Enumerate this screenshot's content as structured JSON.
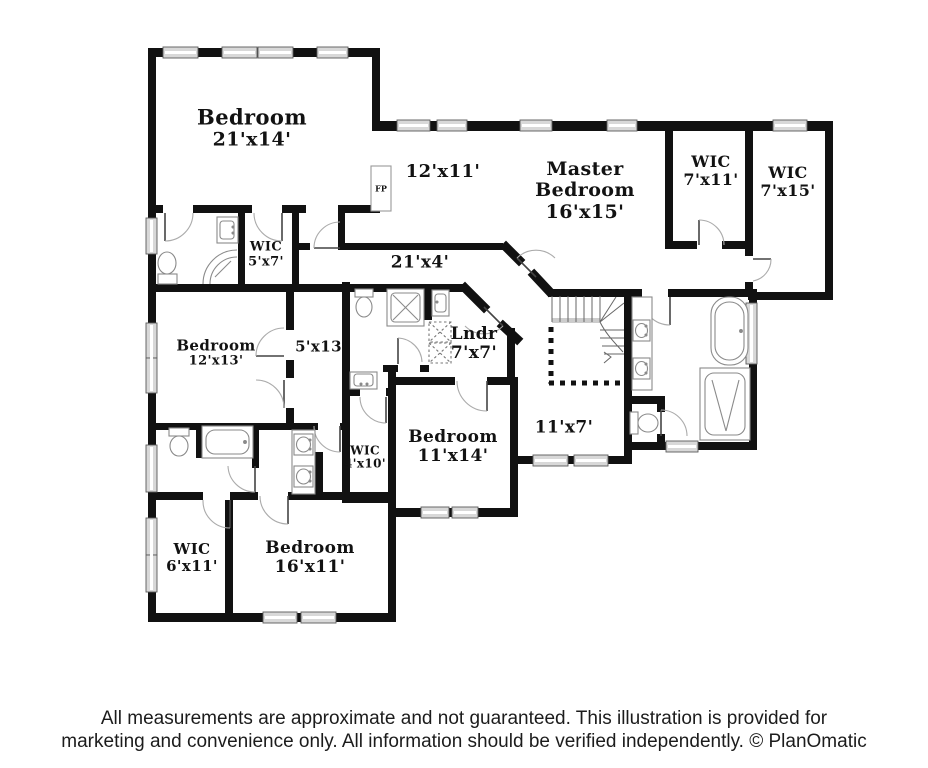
{
  "rooms": {
    "bedroom_21x14": {
      "name": "Bedroom",
      "dims": "21'x14'"
    },
    "sitting_12x11": {
      "dims": "12'x11'"
    },
    "master_bedroom": {
      "name": "Master",
      "name2": "Bedroom",
      "dims": "16'x15'"
    },
    "wic_7x11": {
      "name": "WIC",
      "dims": "7'x11'"
    },
    "wic_7x15": {
      "name": "WIC",
      "dims": "7'x15'"
    },
    "wic_5x7": {
      "name": "WIC",
      "dims": "5'x7'"
    },
    "hall_21x4": {
      "dims": "21'x4'"
    },
    "bedroom_12x13": {
      "name": "Bedroom",
      "dims": "12'x13'"
    },
    "hall_5x13": {
      "dims": "5'x13'"
    },
    "laundry_7x7": {
      "name": "Lndr",
      "dims": "7'x7'"
    },
    "bedroom_11x14": {
      "name": "Bedroom",
      "dims": "11'x14'"
    },
    "hall_11x7": {
      "dims": "11'x7'"
    },
    "wic_4x10": {
      "name": "WIC",
      "dims": "4'x10'"
    },
    "wic_6x11": {
      "name": "WIC",
      "dims": "6'x11'"
    },
    "bedroom_16x11": {
      "name": "Bedroom",
      "dims": "16'x11'"
    },
    "fireplace": {
      "label": "FP"
    }
  },
  "footer": {
    "line1": "All measurements are approximate and not guaranteed. This illustration is provided for",
    "line2": "marketing and convenience only. All information should be verified independently. © PlanOmatic"
  },
  "colors": {
    "wall": "#111111",
    "window_fill": "#d8d8d8",
    "fixture_stroke": "#8a8a8a",
    "door_arc": "#aaaaaa"
  }
}
